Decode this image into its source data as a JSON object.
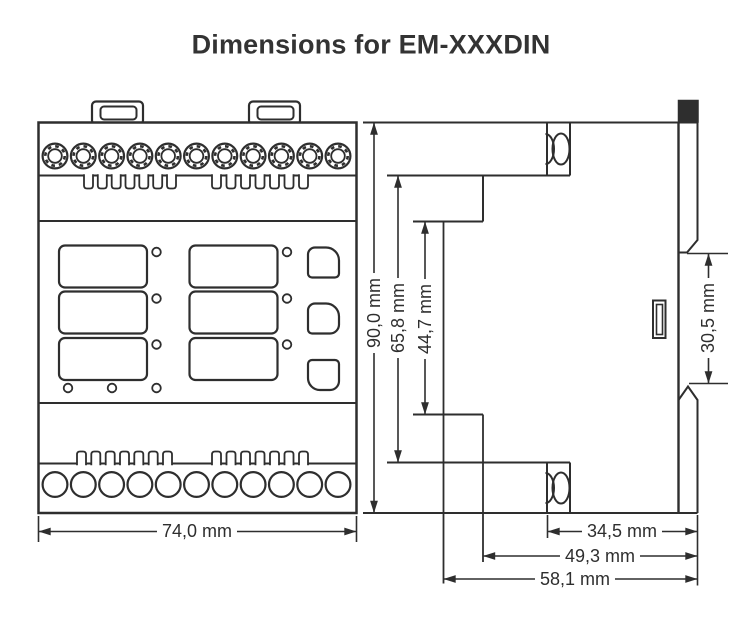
{
  "title": "Dimensions for EM-XXXDIN",
  "colors": {
    "line": "#2e2e2e",
    "background": "#ffffff"
  },
  "views": {
    "front": {
      "name": "front view",
      "mounting_tabs": 2,
      "top_terminals": 11,
      "bottom_terminals": 11,
      "vent_slots_per_group": 7,
      "display_windows": 6,
      "window_led_indicators": 6,
      "status_leds": 3,
      "buttons": 3
    },
    "side": {
      "name": "side view",
      "screw_recesses": 2,
      "din_rail_clips": 2,
      "clip_handle": 1
    }
  },
  "dimensions": {
    "front_width": "74,0 mm",
    "total_height": "90,0 mm",
    "terminal_height": "65,8 mm",
    "center_height": "44,7 mm",
    "rail_gap": "30,5 mm",
    "depth_to_terminal": "34,5 mm",
    "depth_to_step": "49,3 mm",
    "depth_total": "58,1 mm"
  }
}
